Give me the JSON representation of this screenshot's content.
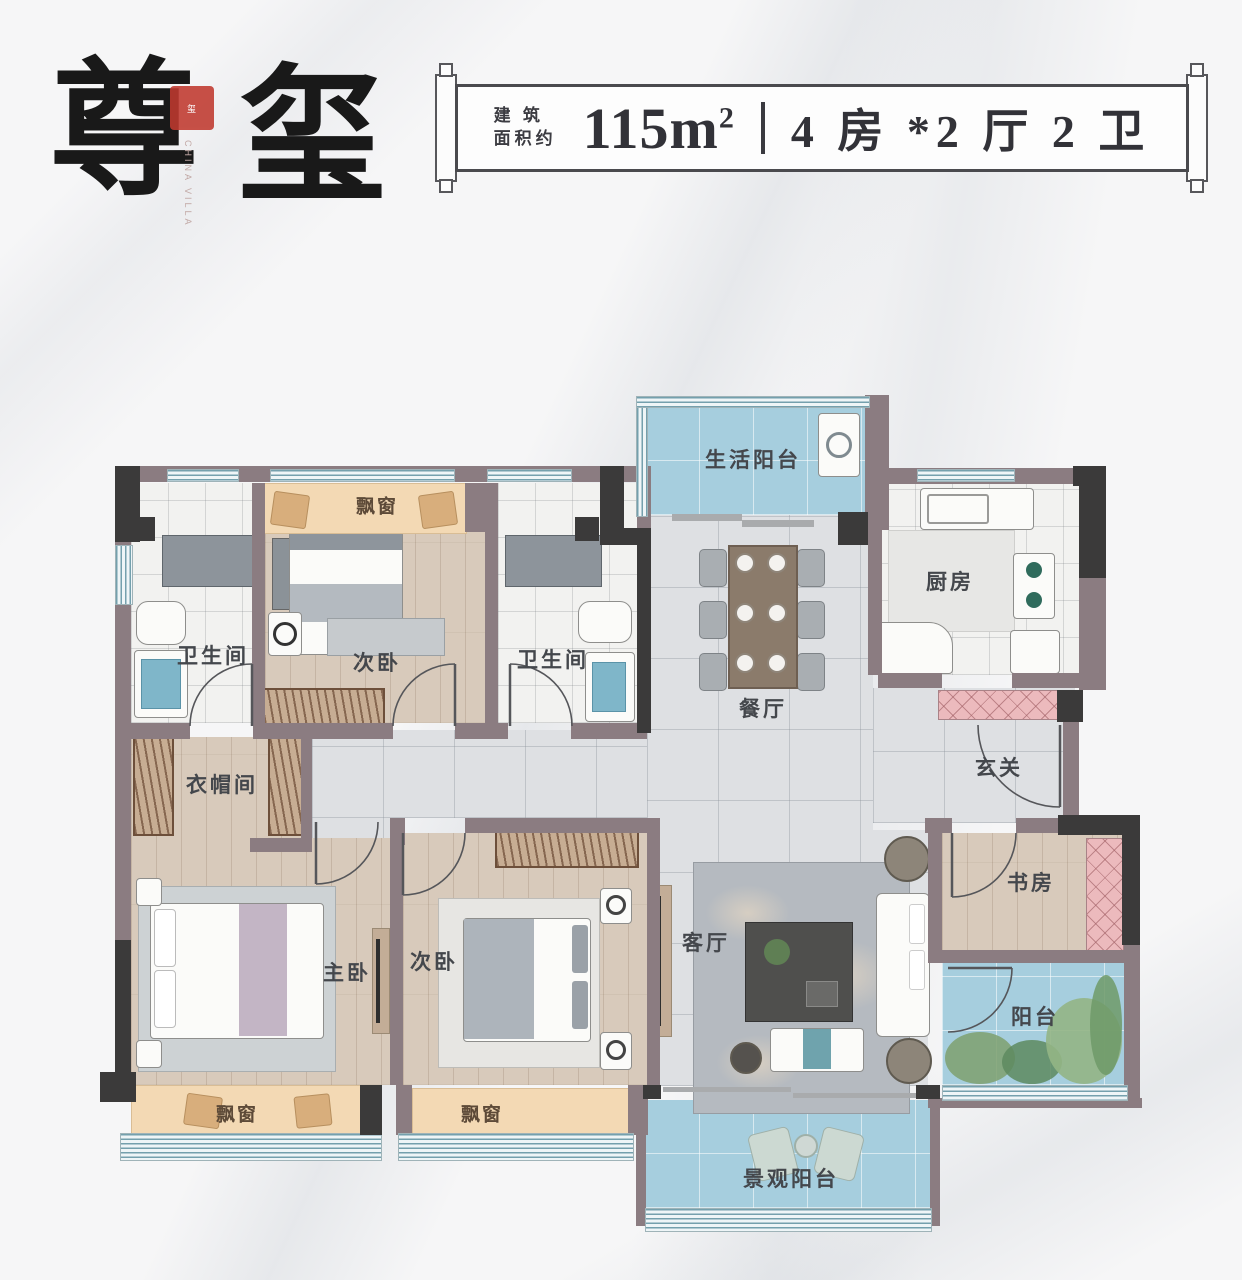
{
  "header": {
    "title_char1": "尊",
    "title_char2": "玺",
    "seal_text": "玺",
    "seal_caption": "CHINA VILLA",
    "banner": {
      "prefix_line1": "建 筑",
      "prefix_line2": "面积约",
      "area_value": "115",
      "area_unit_base": "m",
      "area_unit_sup": "2",
      "layout_text": "4 房 *2 厅 2 卫"
    }
  },
  "rooms": {
    "living_balcony": "生活阳台",
    "kitchen": "厨房",
    "bathroom_1": "卫生间",
    "bedroom_top": "次卧",
    "bathroom_2": "卫生间",
    "dining": "餐厅",
    "foyer": "玄关",
    "cloakroom": "衣帽间",
    "master_bedroom": "主卧",
    "bedroom_bottom": "次卧",
    "living_room": "客厅",
    "study": "书房",
    "balcony": "阳台",
    "view_balcony": "景观阳台",
    "bay_window": "飘窗"
  },
  "colors": {
    "wall": "#8b7c81",
    "column": "#3b3a3a",
    "bay_window": "#f3d9b4",
    "pink_cabinet": "#ecbabd",
    "balcony_blue": "#a6cede",
    "wood_floor": "#d8cabb",
    "tile_floor": "#dee0e3",
    "seal_red": "#c0392f"
  }
}
